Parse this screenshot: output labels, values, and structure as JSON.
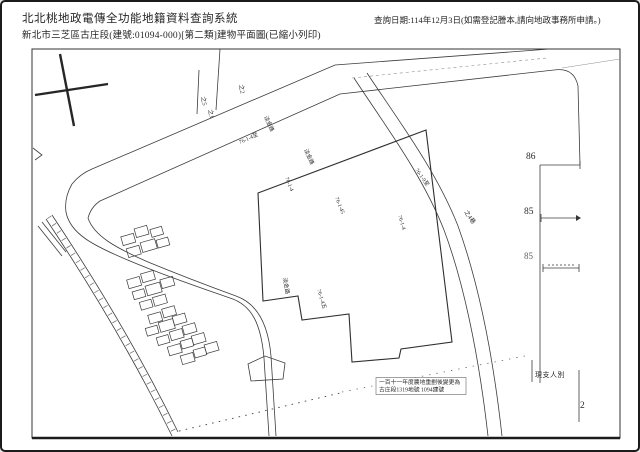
{
  "header": {
    "title": "北北桃地政電傳全功能地籍資料查詢系統",
    "subtitle": "新北市三芝區古庄段(建號:01094-000)[第二類]建物平面圖(已縮小列印)",
    "query_info": "查詢日期:114年12月3日(如需登記謄本,請向地政事務所申請。)"
  },
  "map": {
    "labels": [
      "之5",
      "之2",
      "之1",
      "76-1-4至",
      "淡金路",
      "淡金路",
      "76-1-4",
      "76-1-45",
      "76-1-9至",
      "76-1-4",
      "之4巷",
      "淡金路",
      "76-1-4五"
    ],
    "boundary_numbers": {
      "n1": "86",
      "n2": "85",
      "n3": "85"
    },
    "note": "現支人別",
    "corner_number": "2",
    "annotation": {
      "line1": "一百十一年度農地重劃後變更為",
      "line2": "古庄段1319地號 1094建號"
    }
  },
  "colors": {
    "ink": "#2a2a2a",
    "line": "#3c3c3c",
    "background": "#ffffff"
  }
}
